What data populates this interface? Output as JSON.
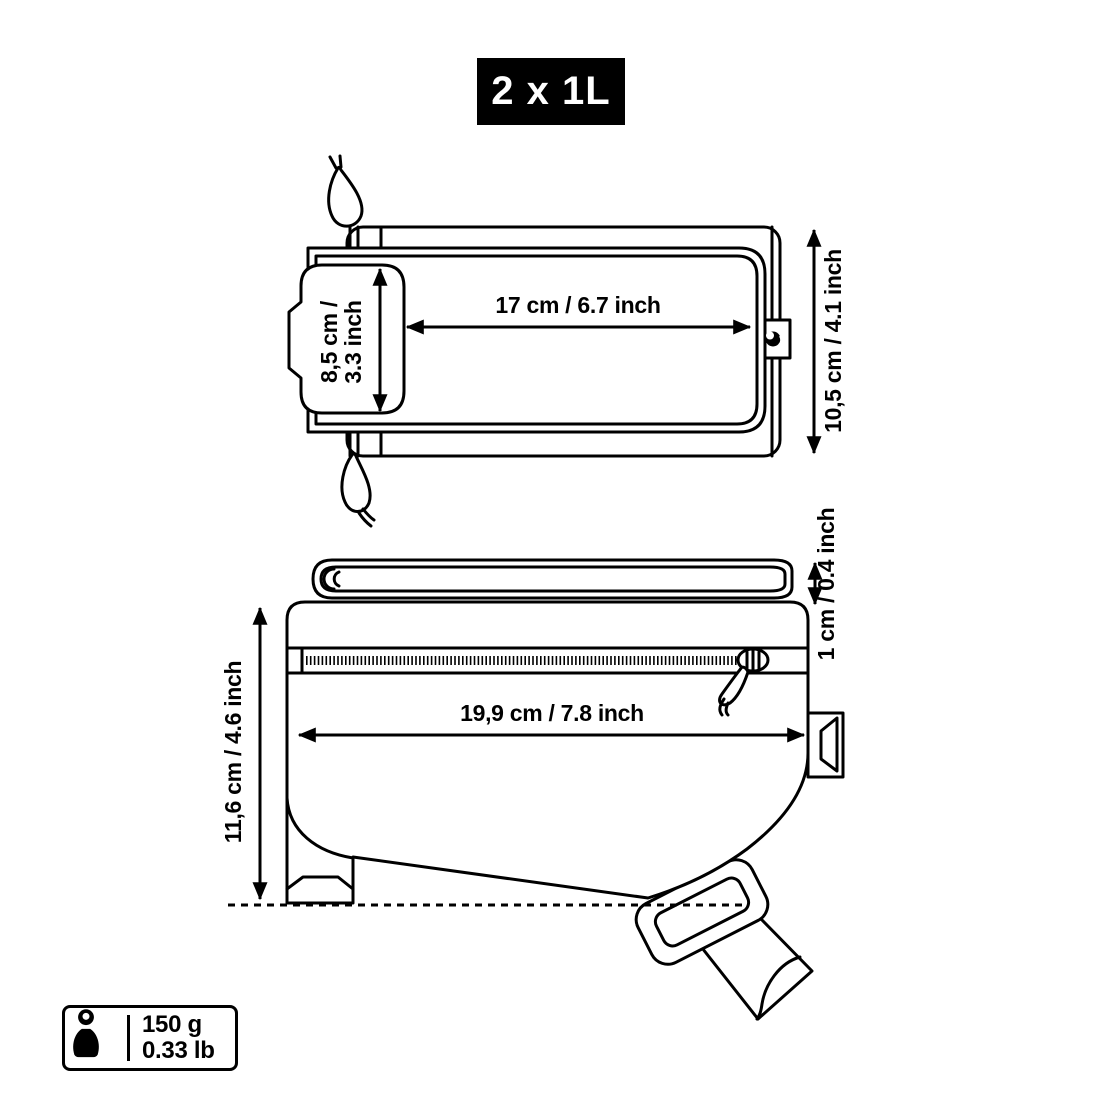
{
  "badge": {
    "label": "2 x 1L"
  },
  "top_view": {
    "width_label": "17 cm / 6.7 inch",
    "flap_label_line1": "8,5 cm /",
    "flap_label_line2": "3.3 inch",
    "height_label": "10,5 cm / 4.1 inch"
  },
  "side_view": {
    "length_label": "19,9 cm / 7.8 inch",
    "height_label": "11,6 cm / 4.6 inch",
    "lid_thickness_label": "1 cm / 0.4 inch"
  },
  "weight": {
    "metric": "150 g",
    "imperial": "0.33 lb"
  },
  "colors": {
    "line": "#000000",
    "background": "#ffffff",
    "badge_background": "#000000",
    "badge_text": "#ffffff"
  },
  "icons": {
    "weight": "kettlebell-weight-icon",
    "zipper_slider": "zipper-slider-icon",
    "zipper_pull": "zipper-pull-icon"
  }
}
